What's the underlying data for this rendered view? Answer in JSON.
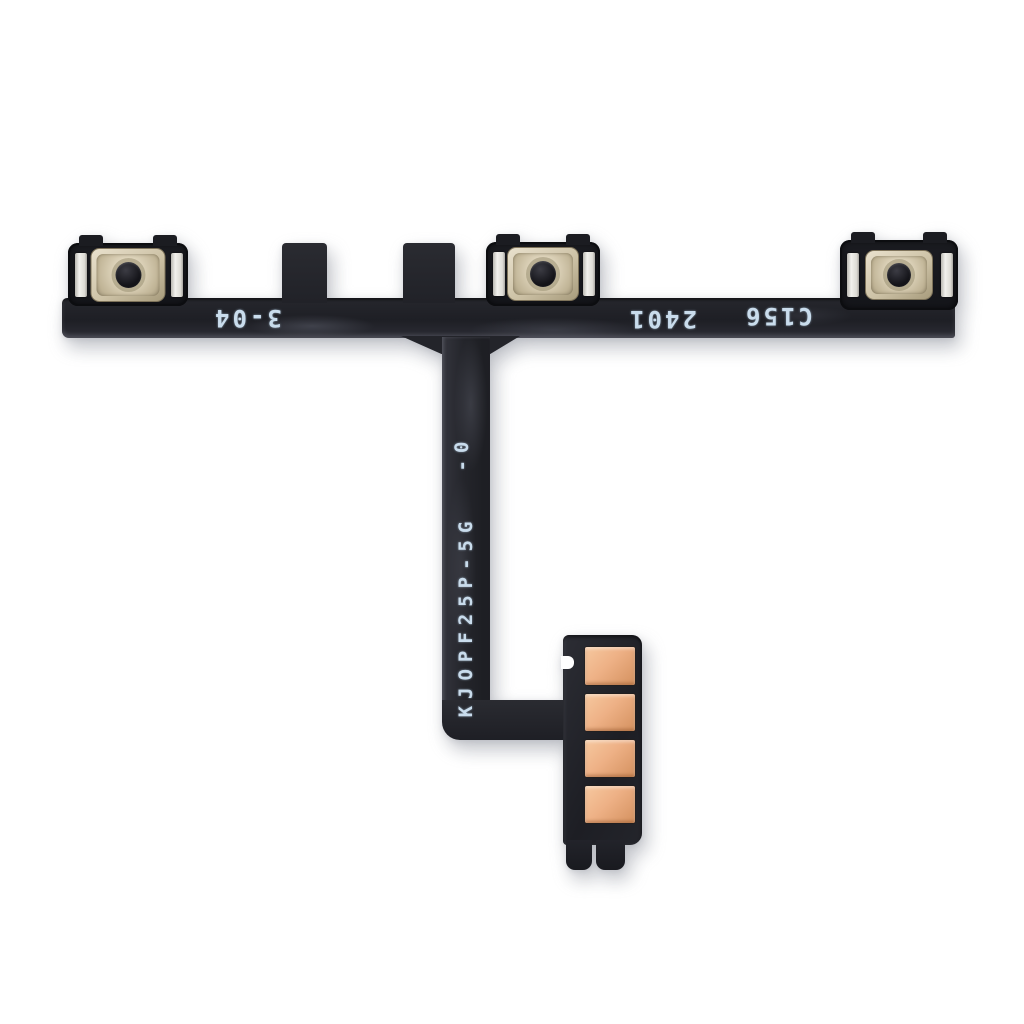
{
  "photo": {
    "subject": "power-volume-button-flex-cable",
    "background": "#ffffff"
  },
  "colors": {
    "bg": "#ffffff",
    "cable": "#25262c",
    "cable-dark": "#17181d",
    "mark-text": "#c9dcec",
    "dome-metal": "#cdc2a6",
    "pin": "#131318",
    "contact": "#f2f1ed",
    "pad": "#eeb186",
    "pad-dark": "#d4915f",
    "shadow": "rgba(125,128,140,0.42)"
  },
  "markings": {
    "left_code": "3-04",
    "date_code": "2401",
    "board_code": "C156",
    "model_code": "KJOPF25P-5G",
    "revision_code": "-0"
  },
  "switches": {
    "count": 3
  },
  "connector": {
    "pad_count": 4
  }
}
